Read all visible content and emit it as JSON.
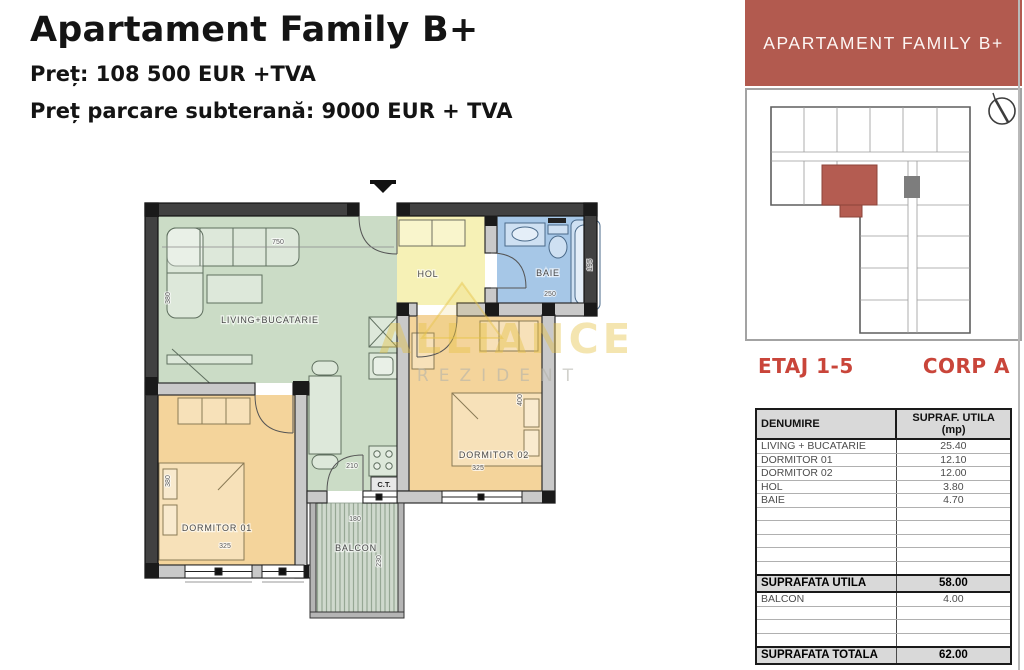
{
  "header": {
    "title": "Apartament Family B+",
    "price_line": "Preț: 108 500 EUR +TVA",
    "parking_line": "Preț parcare subterană: 9000 EUR + TVA"
  },
  "sidebar": {
    "banner": "APARTAMENT FAMILY B+",
    "banner_color": "#b25a4f",
    "accent_red": "#c9453a",
    "etaj": "ETAJ 1-5",
    "corp": "CORP A"
  },
  "watermark": {
    "line1": "ALLIANCE",
    "line2": "REZIDENT"
  },
  "plan": {
    "rooms": {
      "living": "LIVING+BUCATARIE",
      "hol": "HOL",
      "baie": "BAIE",
      "dormitor1": "DORMITOR 01",
      "dormitor2": "DORMITOR 02",
      "balcon": "BALCON",
      "ct": "C.T."
    },
    "dims": {
      "living_w": "750",
      "living_h": "380",
      "dorm1_h": "380",
      "dorm1_w": "325",
      "dorm2_w": "325",
      "dorm2_h": "400",
      "kitchen_w": "210",
      "baie_w": "250",
      "baie_h": "195",
      "balcon_w": "180",
      "balcon_h": "230"
    },
    "colors": {
      "living": "#cbdcc6",
      "hol": "#f6f1b6",
      "baie": "#a6c7e7",
      "dorm": "#f4d49b",
      "balcon_base": "#cfd9cd"
    }
  },
  "table": {
    "headers": [
      "DENUMIRE",
      "SUPRAF. UTILA (mp)"
    ],
    "rows": [
      {
        "label": "LIVING + BUCATARIE",
        "value": "25.40"
      },
      {
        "label": "DORMITOR 01",
        "value": "12.10"
      },
      {
        "label": "DORMITOR 02",
        "value": "12.00"
      },
      {
        "label": "HOL",
        "value": "3.80"
      },
      {
        "label": "BAIE",
        "value": "4.70"
      }
    ],
    "subtotal": {
      "label": "SUPRAFATA UTILA",
      "value": "58.00"
    },
    "balcon_row": {
      "label": "BALCON",
      "value": "4.00"
    },
    "total": {
      "label": "SUPRAFATA TOTALA",
      "value": "62.00"
    }
  }
}
